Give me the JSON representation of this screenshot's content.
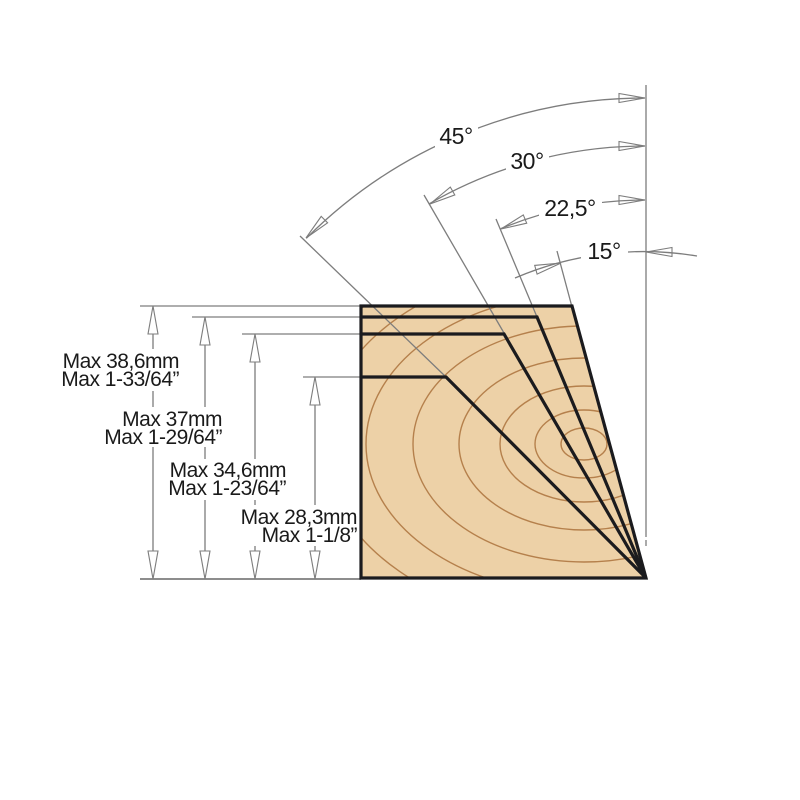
{
  "diagram_type": "chamfer-cutting-angle-and-max-depth-diagram",
  "colors": {
    "wood": "#edd1a7",
    "grain": "#b5804c",
    "outline": "#1b1b1e",
    "line": "#7d7d7d",
    "text": "#1a1a1a",
    "background": "#ffffff"
  },
  "angle_dimensions": [
    {
      "label": "45°",
      "degrees": 45
    },
    {
      "label": "30°",
      "degrees": 30
    },
    {
      "label": "22,5°",
      "degrees": 22.5
    },
    {
      "label": "15°",
      "degrees": 15
    }
  ],
  "depth_dimensions": [
    {
      "metric": "Max 38,6mm",
      "imperial": "Max 1-33/64”",
      "cut_angle": "15°"
    },
    {
      "metric": "Max 37mm",
      "imperial": "Max 1-29/64”",
      "cut_angle": "22,5°"
    },
    {
      "metric": "Max 34,6mm",
      "imperial": "Max 1-23/64”",
      "cut_angle": "30°"
    },
    {
      "metric": "Max 28,3mm",
      "imperial": "Max 1-1/8”",
      "cut_angle": "45°"
    }
  ]
}
